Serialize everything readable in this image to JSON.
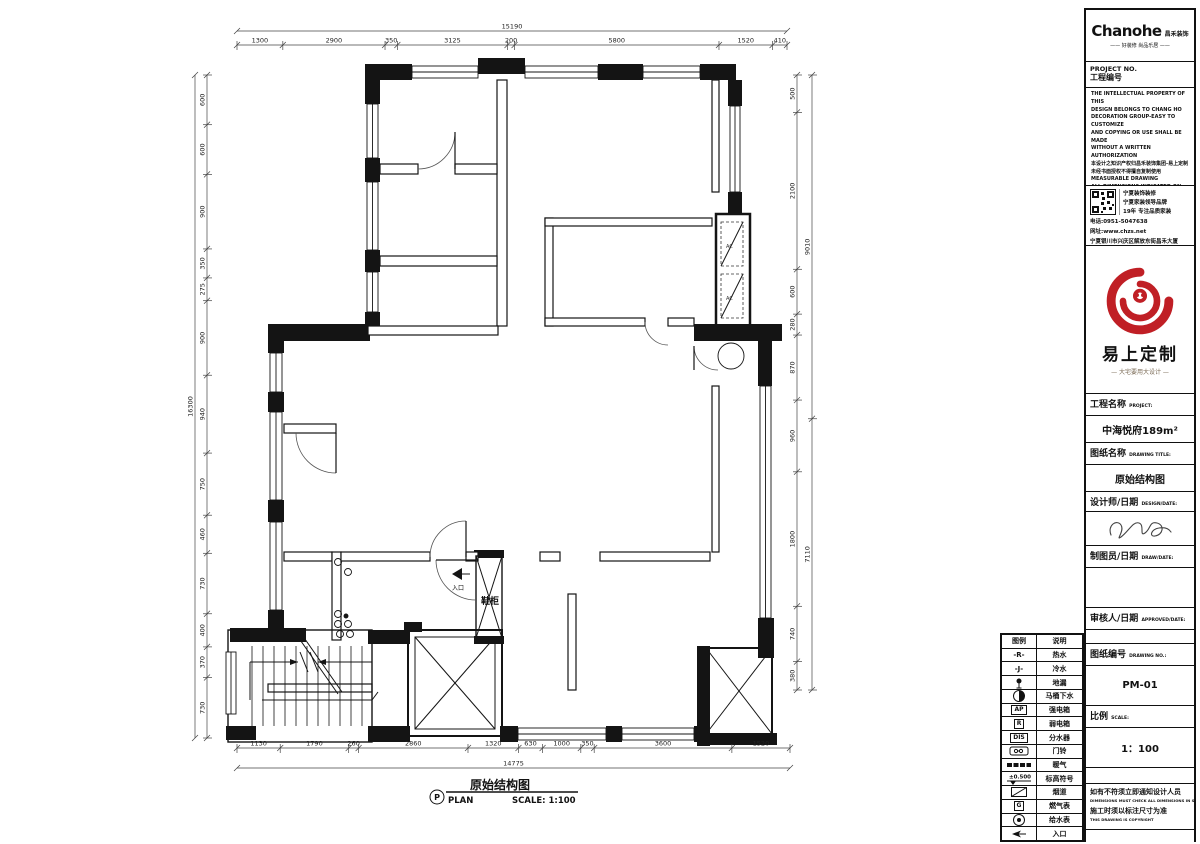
{
  "plan": {
    "caption": {
      "bubble": "P",
      "title": "原始结构图",
      "sub_left": "PLAN",
      "scale_label": "SCALE: 1:100"
    },
    "labels": {
      "shoe_cabinet": "鞋柜",
      "entrance": "入口",
      "ac": "AC"
    },
    "dimensions": [
      {
        "id": "top",
        "dir": "h",
        "x": 237,
        "y": 45,
        "len": 550,
        "segments": [
          "1300",
          "2900",
          "350",
          "3125",
          "200",
          "5800",
          "1520",
          "410"
        ],
        "total": "15190",
        "ty": 31
      },
      {
        "id": "bottom",
        "dir": "h",
        "x": 237,
        "y": 748,
        "len": 553,
        "segments": [
          "1130",
          "1790",
          "260",
          "2860",
          "1320",
          "630",
          "1000",
          "350",
          "3600",
          "1520"
        ],
        "total": "14775",
        "ty": 768
      },
      {
        "id": "left",
        "dir": "v",
        "x": 207,
        "y": 75,
        "len": 663,
        "segments": [
          "600",
          "600",
          "900",
          "350",
          "275",
          "900",
          "940",
          "750",
          "460",
          "730",
          "400",
          "370",
          "730"
        ],
        "total": "16300",
        "tx": 195
      },
      {
        "id": "right-inner",
        "dir": "v",
        "x": 797,
        "y": 75,
        "len": 615,
        "segments": [
          "500",
          "2100",
          "600",
          "280",
          "870",
          "960",
          "1800",
          "740",
          "380"
        ]
      },
      {
        "id": "right-outer",
        "dir": "v",
        "x": 812,
        "y": 75,
        "len": 615,
        "segments": [
          "9010",
          "7110"
        ]
      }
    ]
  },
  "legend": {
    "headers": {
      "symbol": "图例",
      "desc": "说明"
    },
    "rows": [
      {
        "sym": "hot-water",
        "glyph": "-R-",
        "desc": "热水"
      },
      {
        "sym": "cold-water",
        "glyph": "-J-",
        "desc": "冷水"
      },
      {
        "sym": "floor-drain",
        "glyph": "",
        "desc": "地漏"
      },
      {
        "sym": "toilet-drain",
        "glyph": "",
        "desc": "马桶下水"
      },
      {
        "sym": "power-box",
        "glyph": "AP",
        "desc": "强电箱"
      },
      {
        "sym": "weak-box",
        "glyph": "R",
        "desc": "弱电箱"
      },
      {
        "sym": "manifold",
        "glyph": "DIS",
        "desc": "分水器"
      },
      {
        "sym": "doorbell",
        "glyph": "",
        "desc": "门铃"
      },
      {
        "sym": "heating",
        "glyph": "",
        "desc": "暖气"
      },
      {
        "sym": "elevation",
        "glyph": "±0.500",
        "desc": "标高符号"
      },
      {
        "sym": "flue",
        "glyph": "",
        "desc": "烟道"
      },
      {
        "sym": "gas-meter",
        "glyph": "G",
        "desc": "燃气表"
      },
      {
        "sym": "water-meter",
        "glyph": "",
        "desc": "给水表"
      },
      {
        "sym": "entry-arrow",
        "glyph": "",
        "desc": "入口"
      }
    ]
  },
  "titleblock": {
    "brand": {
      "logo_en": "Chanohe",
      "logo_cn": "昌禾装饰",
      "tagline": "—— 好装修 尚品乐居 ——"
    },
    "project_no": {
      "en": "PROJECT NO.",
      "cn": "工程编号"
    },
    "disclaimer": [
      "THE INTELLECTUAL PROPERTY OF THIS",
      "DESIGN BELONGS TO CHANG HO",
      "DECORATION GROUP-EASY TO CUSTOMIZE",
      "AND COPYING OR USE SHALL BE MADE",
      "WITHOUT A WRITTEN AUTHORIZATION",
      "本设计之知识产权归昌禾装饰集团-易上定制",
      "未经书面授权不得擅自复制使用",
      "MEASURABLE DRAWING",
      "ALL DIMENSIONS INDICATED ON THE",
      "DRAWING MUST BE RECOMBINED AND",
      "MODIFIED ON SITE",
      "不得依比例量图.",
      "图纸所标尺寸须现场复核并修正"
    ],
    "contact": {
      "qr_lines": [
        "宁夏装饰装修",
        "宁夏家装领导品牌",
        "19年 专注品质家装"
      ],
      "phone": "电话:0951-5047638",
      "website": "网址:www.chzs.net",
      "address": "宁夏银川市兴庆区解放东街昌禾大厦"
    },
    "red_logo": {
      "name": "易上定制",
      "tagline": "— 大宅要用大设计 —"
    },
    "fields": [
      {
        "label": "工程名称",
        "en": "PROJECT:",
        "value": "中海悦府189m²"
      },
      {
        "label": "图纸名称",
        "en": "DRAWING TITLE:",
        "value": "原始结构图"
      },
      {
        "label": "设计师/日期",
        "en": "DESIGN/DATE:",
        "value": ""
      },
      {
        "label": "制图员/日期",
        "en": "DRAW/DATE:",
        "value": ""
      },
      {
        "label": "审核人/日期",
        "en": "APPROVED/DATE:",
        "value": ""
      },
      {
        "label": "图纸编号",
        "en": "DRAWING NO.:",
        "value": "PM-01"
      },
      {
        "label": "比例",
        "en": "SCALE:",
        "value": "1：100"
      }
    ],
    "notes": {
      "cn1": "如有不符须立即通知设计人员",
      "en1": "DIMENSIONS MUST CHECK ALL DIMENSIONS IN SITU",
      "cn2": "施工时须以标注尺寸为准",
      "en2": "THIS DRAWING IS COPYRIGHT"
    }
  }
}
